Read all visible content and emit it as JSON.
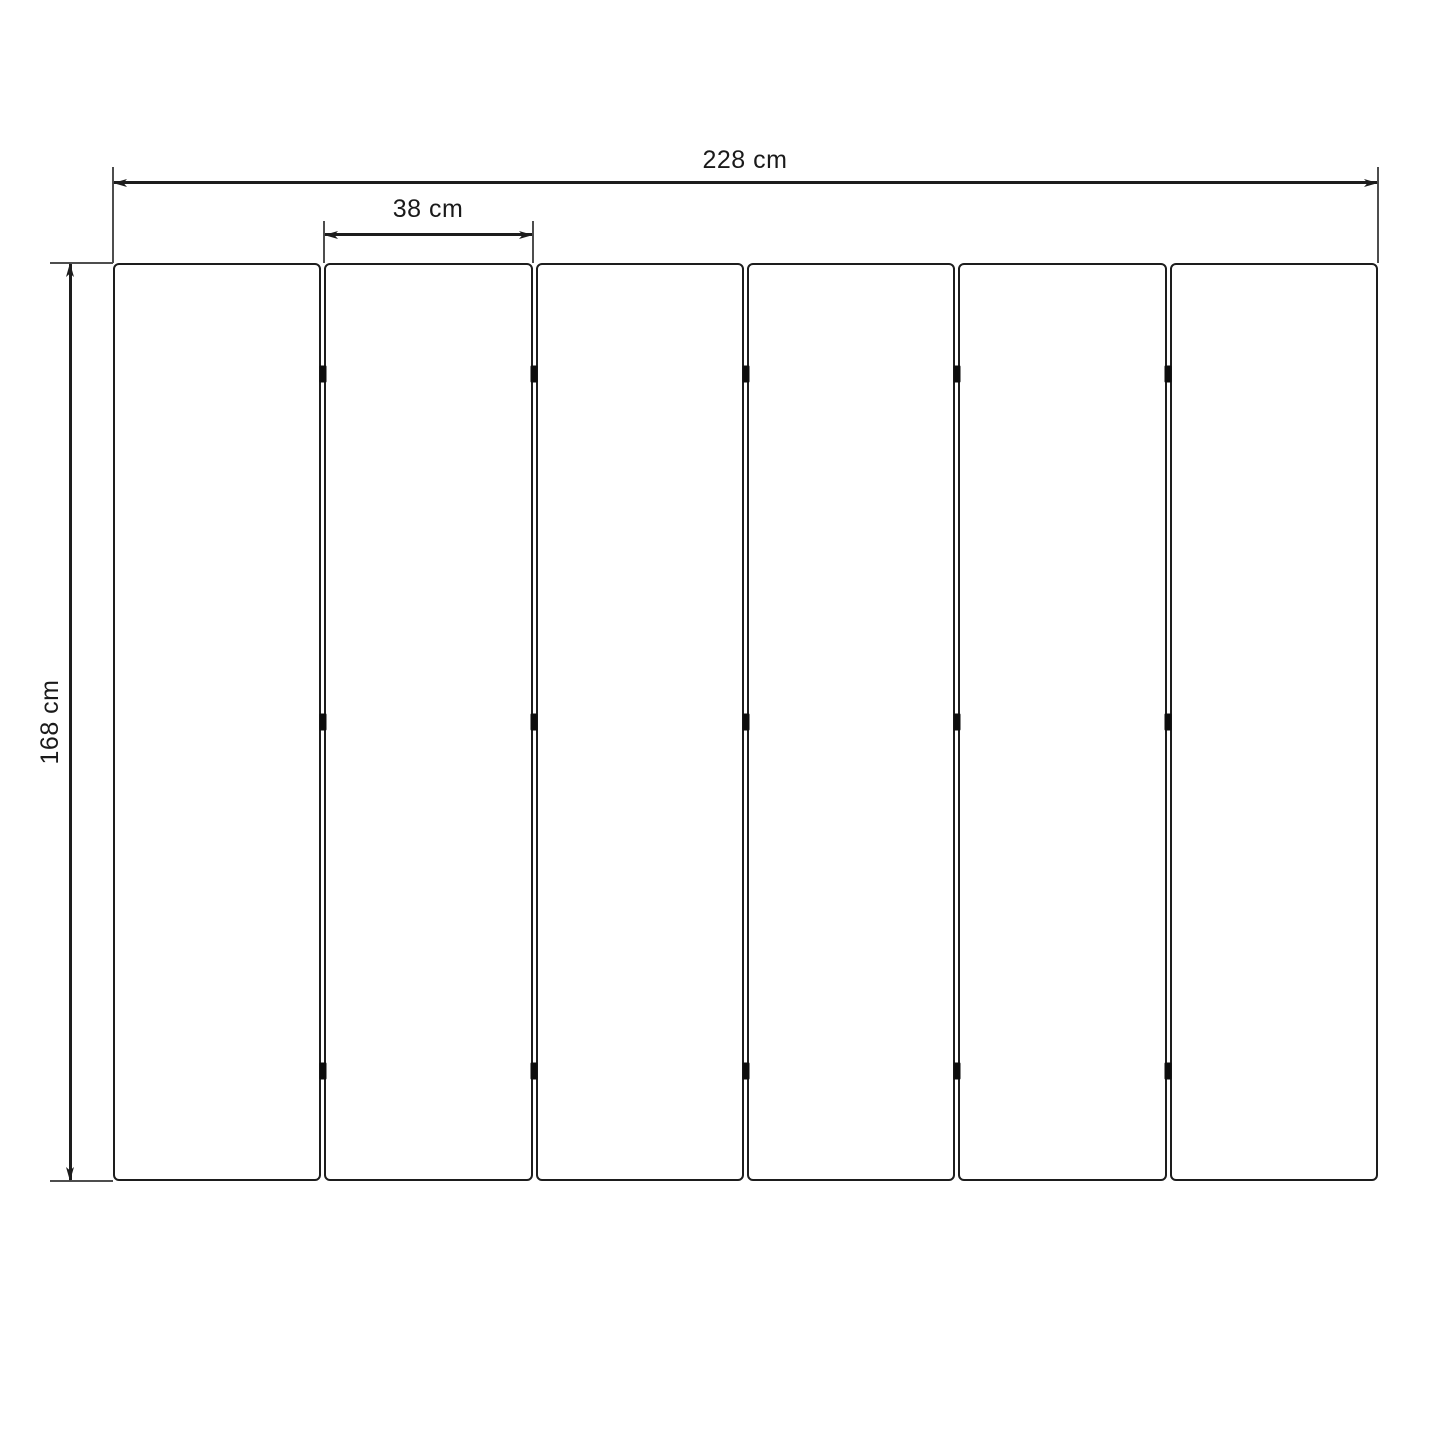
{
  "diagram": {
    "title": "panel-dimension-drawing",
    "panels": {
      "count": 6,
      "gap_count": 5
    },
    "hinges": {
      "per_gap": 3
    },
    "dimensions": {
      "total_width": {
        "label": "228 cm",
        "value": 228,
        "unit": "cm"
      },
      "panel_width": {
        "label": "38 cm",
        "value": 38,
        "unit": "cm"
      },
      "height": {
        "label": "168 cm",
        "value": 168,
        "unit": "cm"
      }
    },
    "colors": {
      "line": "#1d1d1d",
      "extension_line": "#4d4d4d",
      "hinge": "#0d0d0d",
      "background": "#ffffff",
      "text": "#1a1a1a"
    }
  }
}
